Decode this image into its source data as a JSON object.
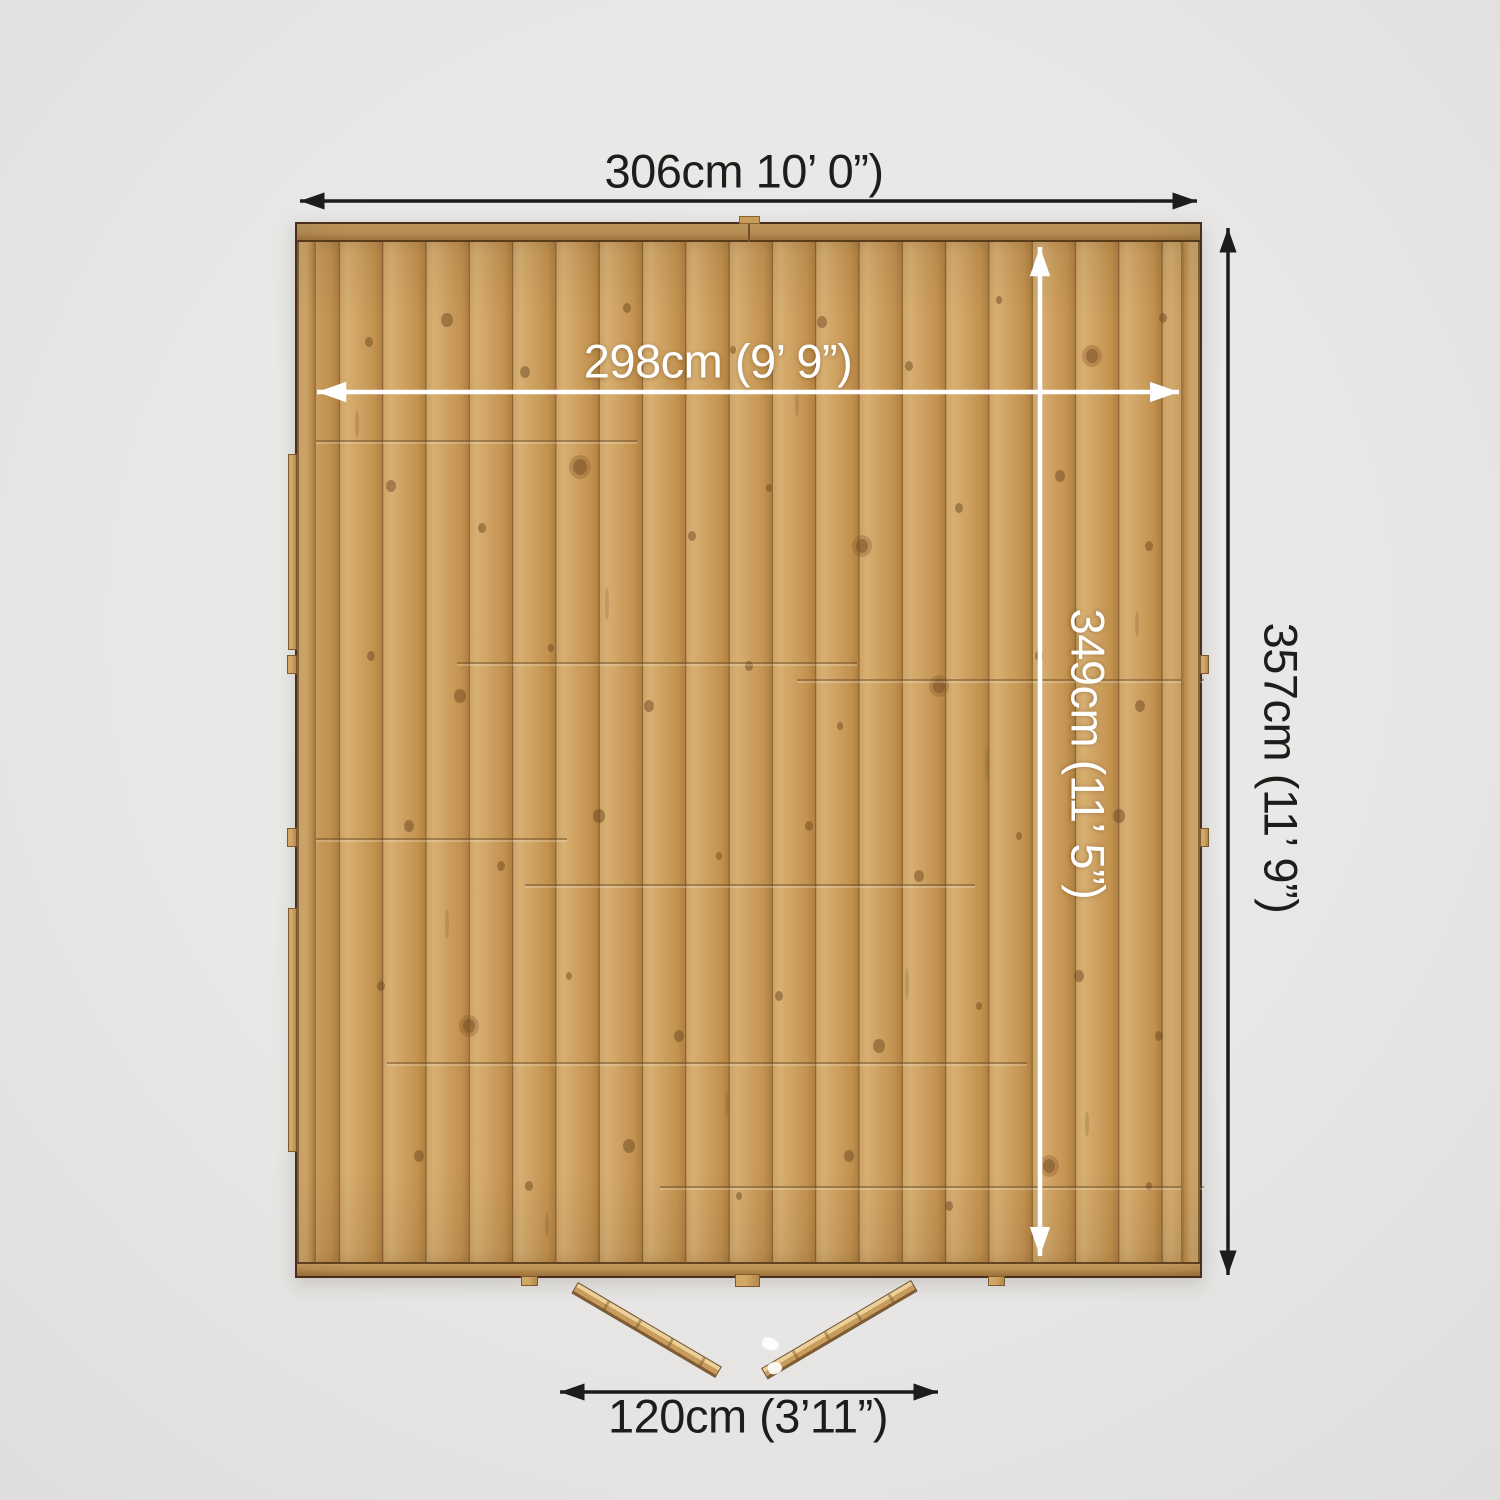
{
  "diagram": {
    "title": "Shed floor plan - top view with dimensions",
    "labels": {
      "outer_width": "306cm 10’ 0”)",
      "inner_width": "298cm (9’ 9”)",
      "inner_depth": "349cm (11’ 5”)",
      "outer_depth": "357cm (11’ 9”)",
      "door_width": "120cm (3’11”)"
    },
    "colors": {
      "background": "#e9e8e6",
      "wood": "#c99e5f",
      "wood_frame": "#b68a4c",
      "wood_dark": "#7d5a2c",
      "arrow_dark": "#1c1c1c",
      "arrow_light": "#ffffff"
    }
  }
}
